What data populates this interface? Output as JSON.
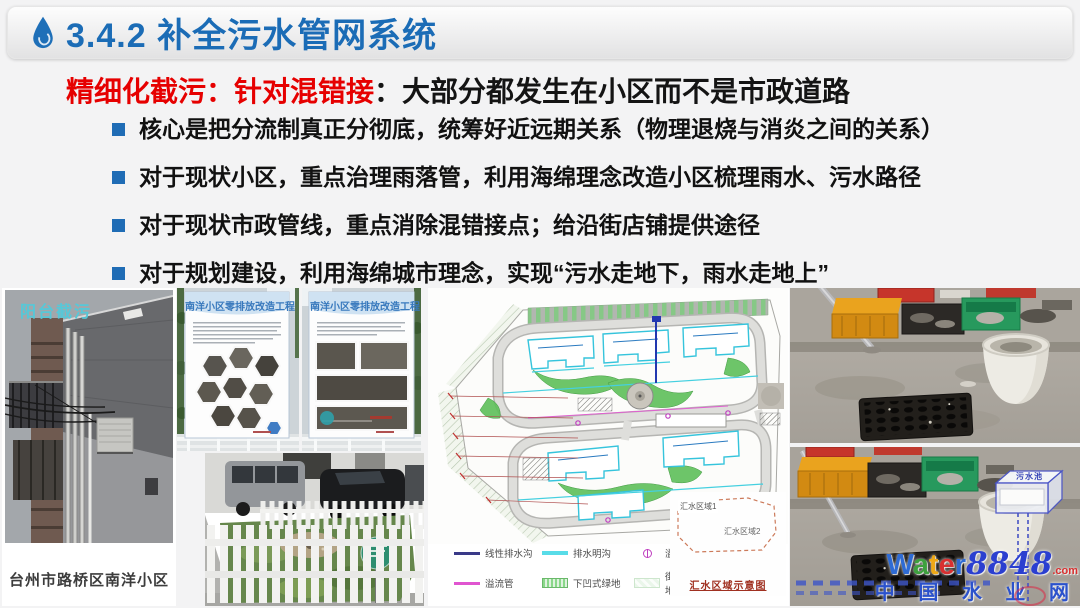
{
  "colors": {
    "header_blue": "#1b6cb6",
    "accent_red": "#e60000",
    "bullet_blue": "#1f6cb5",
    "balcony_label_teal": "#56c8d8",
    "poster_title_blue": "#3879bd",
    "legend_navy": "#3a3a88",
    "legend_cyan": "#58dce8",
    "legend_magenta": "#e055d0",
    "legend_well_magenta": "#c040c0",
    "inset_dash_red": "#cc7a5a",
    "watermark_blue": "#2b3fd0",
    "watermark_red": "#d83030"
  },
  "header": {
    "title": "3.4.2 补全污水管网系统",
    "icon": "water-drop-icon"
  },
  "intro": {
    "highlight": "精细化截污：针对混错接",
    "rest": "：大部分都发生在小区而不是市政道路"
  },
  "bullets": [
    "核心是把分流制真正分彻底，统筹好近远期关系（物理退烧与消炎之间的关系）",
    "对于现状小区，重点治理雨落管，利用海绵理念改造小区梳理雨水、污水路径",
    "对于现状市政管线，重点消除混错接点；给沿街店铺提供途径",
    "对于规划建设，利用海绵城市理念，实现“污水走地下，雨水走地上”"
  ],
  "photos": {
    "balcony": {
      "label": "阳台截污",
      "caption": "台州市路桥区南洋小区"
    },
    "signboard1": {
      "title": "南洋小区零排放改造工程"
    },
    "signboard2": {
      "title": "南洋小区零排放改造工程"
    }
  },
  "siteplan": {
    "legend": [
      {
        "label": "线性排水沟"
      },
      {
        "label": "排水明沟"
      },
      {
        "label": "溢流井"
      },
      {
        "label": "溢流管"
      },
      {
        "label": "下凹式绿地"
      },
      {
        "label": "街旁绿地"
      },
      {
        "label": "汇流方向"
      },
      {
        "label": "出水口"
      }
    ],
    "inset": {
      "area1": "汇水区域1",
      "area2": "汇水区域2",
      "caption": "汇水区域示意图"
    }
  },
  "annotations": {
    "sewage_tank": "污水池"
  },
  "watermark": {
    "letters": [
      "W",
      "a",
      "t",
      "e",
      "r"
    ],
    "number": "8848",
    "suffix": ".com",
    "site_name": "中 国 水 业 网"
  }
}
